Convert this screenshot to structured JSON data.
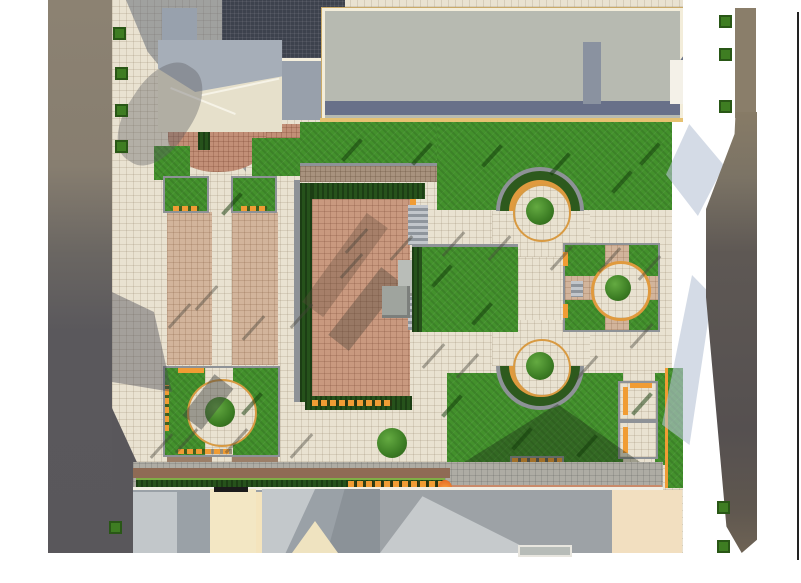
{
  "meta": {
    "title": "Aerial rendering of landscaped plaza site plan",
    "view": "top-down 3D architectural rendering",
    "visible_text": []
  },
  "colors": {
    "page_bg": "#ffffff",
    "frame_line": "#222222",
    "pavement": "#e9e2d1",
    "stripe_tan": "#d2b49b",
    "plaza_pink": "#c9997f",
    "brick_apron": "#c28f77",
    "path_brown": "#a8927e",
    "path_dark_brown": "#9c7f68",
    "road_gray": "#aeaca4",
    "lawn_green": "#43912c",
    "hedge_green": "#26521b",
    "tree_green": "#3e7d22",
    "orange_bench": "#f09c34",
    "orange_rim": "#d89a42",
    "curb_gray": "#8e9297",
    "ring_green": "#2d5a1d",
    "left_band_brown": "#8c8272",
    "left_band_dark": "#59575b",
    "dark_roof": "#3d424d",
    "big_building_roof": "#b7bab1",
    "big_building_border": "#f3edda",
    "big_building_trim": "#e6c171",
    "big_building_band": "#687089",
    "house_wall": "#98a1ad",
    "house_roof_cream": "#e6e0cb",
    "house_roof_gray": "#a6aeb8",
    "shaded_pavement": "#98a0ab",
    "right_building_brown": "#8a7e6a",
    "right_building_dark": "#555050",
    "blue_shadow": "#b8c3d6",
    "bottom_roof_gray": "#9aa1a7",
    "bottom_roof_light": "#c3c8cb",
    "bottom_wall_cream": "#f3e7c4",
    "bottom_pale": "#f4e4bd",
    "bottom_cream_right": "#f2dfc0",
    "salmon_wall": "#c98a6a",
    "maroon_band": "#8f6b55",
    "black_band": "#1b1b1b",
    "monument_light": "#b9bdb8",
    "monument_dark": "#9fa49e",
    "wing_white": "#f4f1e8",
    "wing_gray": "#8a8f98",
    "gray_wedge": "#8a92a0",
    "flame_orange": "#f59a3c",
    "white": "#ffffff"
  },
  "scene": {
    "regions": [
      "street band with trees (left)",
      "gabled pavilion with brick apron (top left)",
      "large flat-roof building (top)",
      "dark gridded roof (top centre-left)",
      "upper lawn with semicircular tree planter",
      "sunken pink brick plaza with hedges, benches and monument",
      "central lawn panel",
      "striped tan walkways (left plaza)",
      "square planters with orange benches",
      "lower square garden with circular tree plaza",
      "lower semicircular tree planter",
      "four-quadrant garden with circular path (right)",
      "large south-east lawn with bench squares",
      "south hedge row, salmon wall and building roofs (bottom)",
      "tall dark building and street trees (right)",
      "thin dark frame line (far right)"
    ]
  }
}
